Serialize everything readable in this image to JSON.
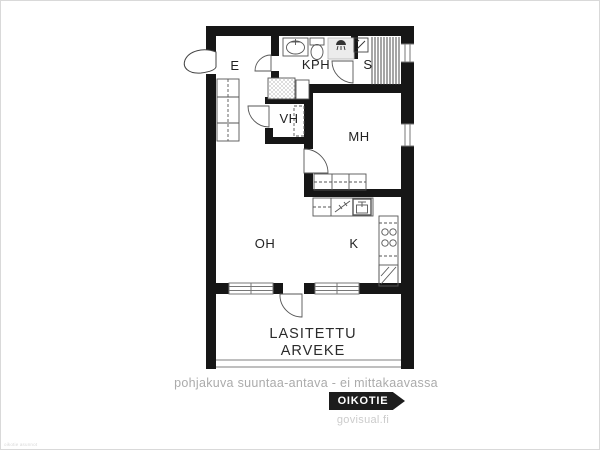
{
  "floorplan": {
    "room_labels": {
      "entrance": "E",
      "bathroom": "KPH",
      "sauna": "S",
      "walkin_closet": "VH",
      "bedroom": "MH",
      "living_room": "OH",
      "kitchen": "K"
    },
    "balcony_label_line1": "LASITETTU",
    "balcony_label_line2": "ARVEKE",
    "icons": [
      "entrance-door-icon",
      "door-swing-arc",
      "window-lines",
      "washbasin-icon",
      "toilet-icon",
      "shower-icon",
      "sauna-stove-icon",
      "sauna-bench-lines",
      "wardrobe-icon",
      "washing-machine-icon",
      "dishwasher-icon",
      "kitchen-sink-icon",
      "stove-hob-icon",
      "fridge-icon",
      "balcony-glazing-lines"
    ]
  },
  "footer": {
    "disclaimer": "pohjakuva suuntaa-antava - ei mittakaavassa",
    "brand_badge": "OIKOTIE",
    "credit": "govisual.fi"
  },
  "watermark": "oikotie asunnot",
  "colors": {
    "wall": "#161616",
    "thin_line": "#555555",
    "label": "#222222",
    "muted_text": "#ababab",
    "badge_bg": "#1d1d1d",
    "badge_text": "#ffffff",
    "credit_text": "#cccccc",
    "background": "#ffffff"
  }
}
